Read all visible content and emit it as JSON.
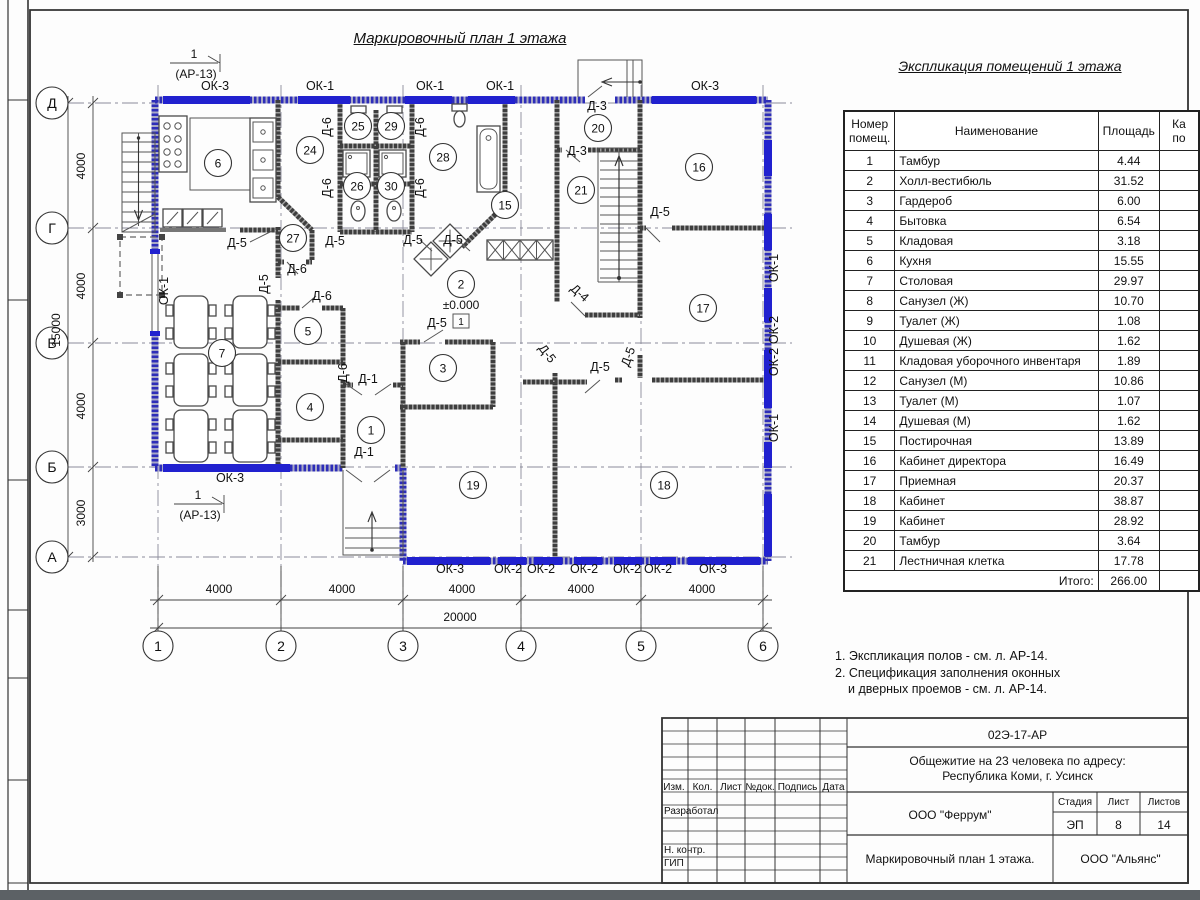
{
  "plan": {
    "title": "Маркировочный план 1 этажа",
    "level_mark": "±0.000",
    "floor_type_mark": "1",
    "section_marker": {
      "num": "1",
      "ref": "(АР-13)"
    },
    "axes_rows": [
      [
        "Д",
        103
      ],
      [
        "Г",
        228
      ],
      [
        "В",
        343
      ],
      [
        "Б",
        467
      ],
      [
        "А",
        557
      ]
    ],
    "axes_cols": [
      [
        "1",
        158
      ],
      [
        "2",
        281
      ],
      [
        "3",
        403
      ],
      [
        "4",
        521
      ],
      [
        "5",
        641
      ],
      [
        "6",
        763
      ]
    ],
    "dims_left": [
      [
        "4000",
        85,
        166
      ],
      [
        "4000",
        85,
        286
      ],
      [
        "4000",
        85,
        406
      ],
      [
        "3000",
        85,
        513
      ]
    ],
    "dim_left_total": [
      "15000",
      60,
      330
    ],
    "dims_bottom": [
      [
        "4000",
        219,
        593
      ],
      [
        "4000",
        342,
        593
      ],
      [
        "4000",
        462,
        593
      ],
      [
        "4000",
        581,
        593
      ],
      [
        "4000",
        702,
        593
      ]
    ],
    "dim_bottom_total": [
      "20000",
      460,
      621
    ],
    "rooms": [
      [
        "6",
        218,
        163
      ],
      [
        "24",
        310,
        150
      ],
      [
        "25",
        358,
        126
      ],
      [
        "29",
        391,
        126
      ],
      [
        "26",
        357,
        186
      ],
      [
        "30",
        391,
        186
      ],
      [
        "27",
        293,
        238
      ],
      [
        "28",
        443,
        157
      ],
      [
        "15",
        505,
        205
      ],
      [
        "20",
        598,
        128
      ],
      [
        "21",
        581,
        190
      ],
      [
        "16",
        699,
        167
      ],
      [
        "17",
        703,
        308
      ],
      [
        "2",
        461,
        284
      ],
      [
        "5",
        308,
        331
      ],
      [
        "7",
        222,
        353
      ],
      [
        "3",
        443,
        368
      ],
      [
        "4",
        310,
        407
      ],
      [
        "1",
        371,
        430
      ],
      [
        "19",
        473,
        485
      ],
      [
        "18",
        664,
        485
      ]
    ],
    "door_labels": [
      [
        "Д-6",
        331,
        127,
        -90
      ],
      [
        "Д-6",
        424,
        127,
        -90
      ],
      [
        "Д-6",
        331,
        188,
        -90
      ],
      [
        "Д-6",
        424,
        188,
        -90
      ],
      [
        "Д-5",
        237,
        247,
        0
      ],
      [
        "Д-5",
        335,
        245,
        0
      ],
      [
        "Д-5",
        413,
        244,
        0
      ],
      [
        "Д-5",
        453,
        244,
        0
      ],
      [
        "Д-5",
        268,
        284,
        -90
      ],
      [
        "Д-6",
        297,
        273,
        0
      ],
      [
        "Д-6",
        322,
        300,
        0
      ],
      [
        "Д-6",
        347,
        373,
        -90
      ],
      [
        "Д-1",
        368,
        383,
        0
      ],
      [
        "Д-1",
        364,
        456,
        0
      ],
      [
        "Д-3",
        597,
        110,
        0
      ],
      [
        "Д-3",
        577,
        155,
        0
      ],
      [
        "Д-5",
        437,
        327,
        0
      ],
      [
        "Д-5",
        544,
        356,
        52
      ],
      [
        "Д-5",
        600,
        371,
        0
      ],
      [
        "Д-5",
        632,
        358,
        -70
      ],
      [
        "Д-4",
        577,
        296,
        42
      ],
      [
        "Д-5",
        660,
        216,
        0
      ]
    ],
    "window_labels": [
      [
        "ОК-3",
        215,
        90,
        0
      ],
      [
        "ОК-1",
        320,
        90,
        0
      ],
      [
        "ОК-1",
        430,
        90,
        0
      ],
      [
        "ОК-1",
        500,
        90,
        0
      ],
      [
        "ОК-3",
        705,
        90,
        0
      ],
      [
        "ОК-3",
        230,
        482,
        0
      ],
      [
        "ОК-3",
        450,
        573,
        0
      ],
      [
        "ОК-2",
        508,
        573,
        0
      ],
      [
        "ОК-2",
        541,
        573,
        0
      ],
      [
        "ОК-2",
        584,
        573,
        0
      ],
      [
        "ОК-2",
        627,
        573,
        0
      ],
      [
        "ОК-2",
        658,
        573,
        0
      ],
      [
        "ОК-3",
        713,
        573,
        0
      ],
      [
        "ОК-1",
        168,
        291,
        -90
      ],
      [
        "ОК-1",
        778,
        268,
        -90
      ],
      [
        "ОК-2",
        778,
        330,
        -90
      ],
      [
        "ОК-2",
        778,
        362,
        -90
      ],
      [
        "ОК-1",
        778,
        428,
        -90
      ]
    ]
  },
  "explication": {
    "title": "Экспликация помещений 1 этажа",
    "headers": [
      "Номер\nпомещ.",
      "Наименование",
      "Площадь",
      "Ка\nпо"
    ],
    "rows": [
      [
        "1",
        "Тамбур",
        "4.44"
      ],
      [
        "2",
        "Холл-вестибюль",
        "31.52"
      ],
      [
        "3",
        "Гардероб",
        "6.00"
      ],
      [
        "4",
        "Бытовка",
        "6.54"
      ],
      [
        "5",
        "Кладовая",
        "3.18"
      ],
      [
        "6",
        "Кухня",
        "15.55"
      ],
      [
        "7",
        "Столовая",
        "29.97"
      ],
      [
        "8",
        "Санузел (Ж)",
        "10.70"
      ],
      [
        "9",
        "Туалет (Ж)",
        "1.08"
      ],
      [
        "10",
        "Душевая (Ж)",
        "1.62"
      ],
      [
        "11",
        "Кладовая уборочного инвентаря",
        "1.89"
      ],
      [
        "12",
        "Санузел (М)",
        "10.86"
      ],
      [
        "13",
        "Туалет (М)",
        "1.07"
      ],
      [
        "14",
        "Душевая (М)",
        "1.62"
      ],
      [
        "15",
        "Постирочная",
        "13.89"
      ],
      [
        "16",
        "Кабинет директора",
        "16.49"
      ],
      [
        "17",
        "Приемная",
        "20.37"
      ],
      [
        "18",
        "Кабинет",
        "38.87"
      ],
      [
        "19",
        "Кабинет",
        "28.92"
      ],
      [
        "20",
        "Тамбур",
        "3.64"
      ],
      [
        "21",
        "Лестничная клетка",
        "17.78"
      ]
    ],
    "total_label": "Итого:",
    "total": "266.00"
  },
  "notes": [
    "1. Экспликация полов - см. л. АР-14.",
    "2. Спецификация заполнения оконных",
    "и дверных проемов - см. л. АР-14."
  ],
  "titleblock": {
    "doc_number": "02Э-17-АР",
    "project_line1": "Общежитие на 23 человека по адресу:",
    "project_line2": "Республика Коми, г. Усинск",
    "org": "ООО \"Феррум\"",
    "stage_label": "Стадия",
    "sheet_label": "Лист",
    "sheets_label": "Листов",
    "stage": "ЭП",
    "sheet": "8",
    "sheets": "14",
    "drawing_title": "Маркировочный план 1 этажа.",
    "org2": "ООО \"Альянс\"",
    "cols": [
      "Изм.",
      "Кол.",
      "Лист",
      "№док.",
      "Подпись",
      "Дата"
    ],
    "roles": [
      "Разработал",
      "Н. контр.",
      "ГИП"
    ]
  }
}
